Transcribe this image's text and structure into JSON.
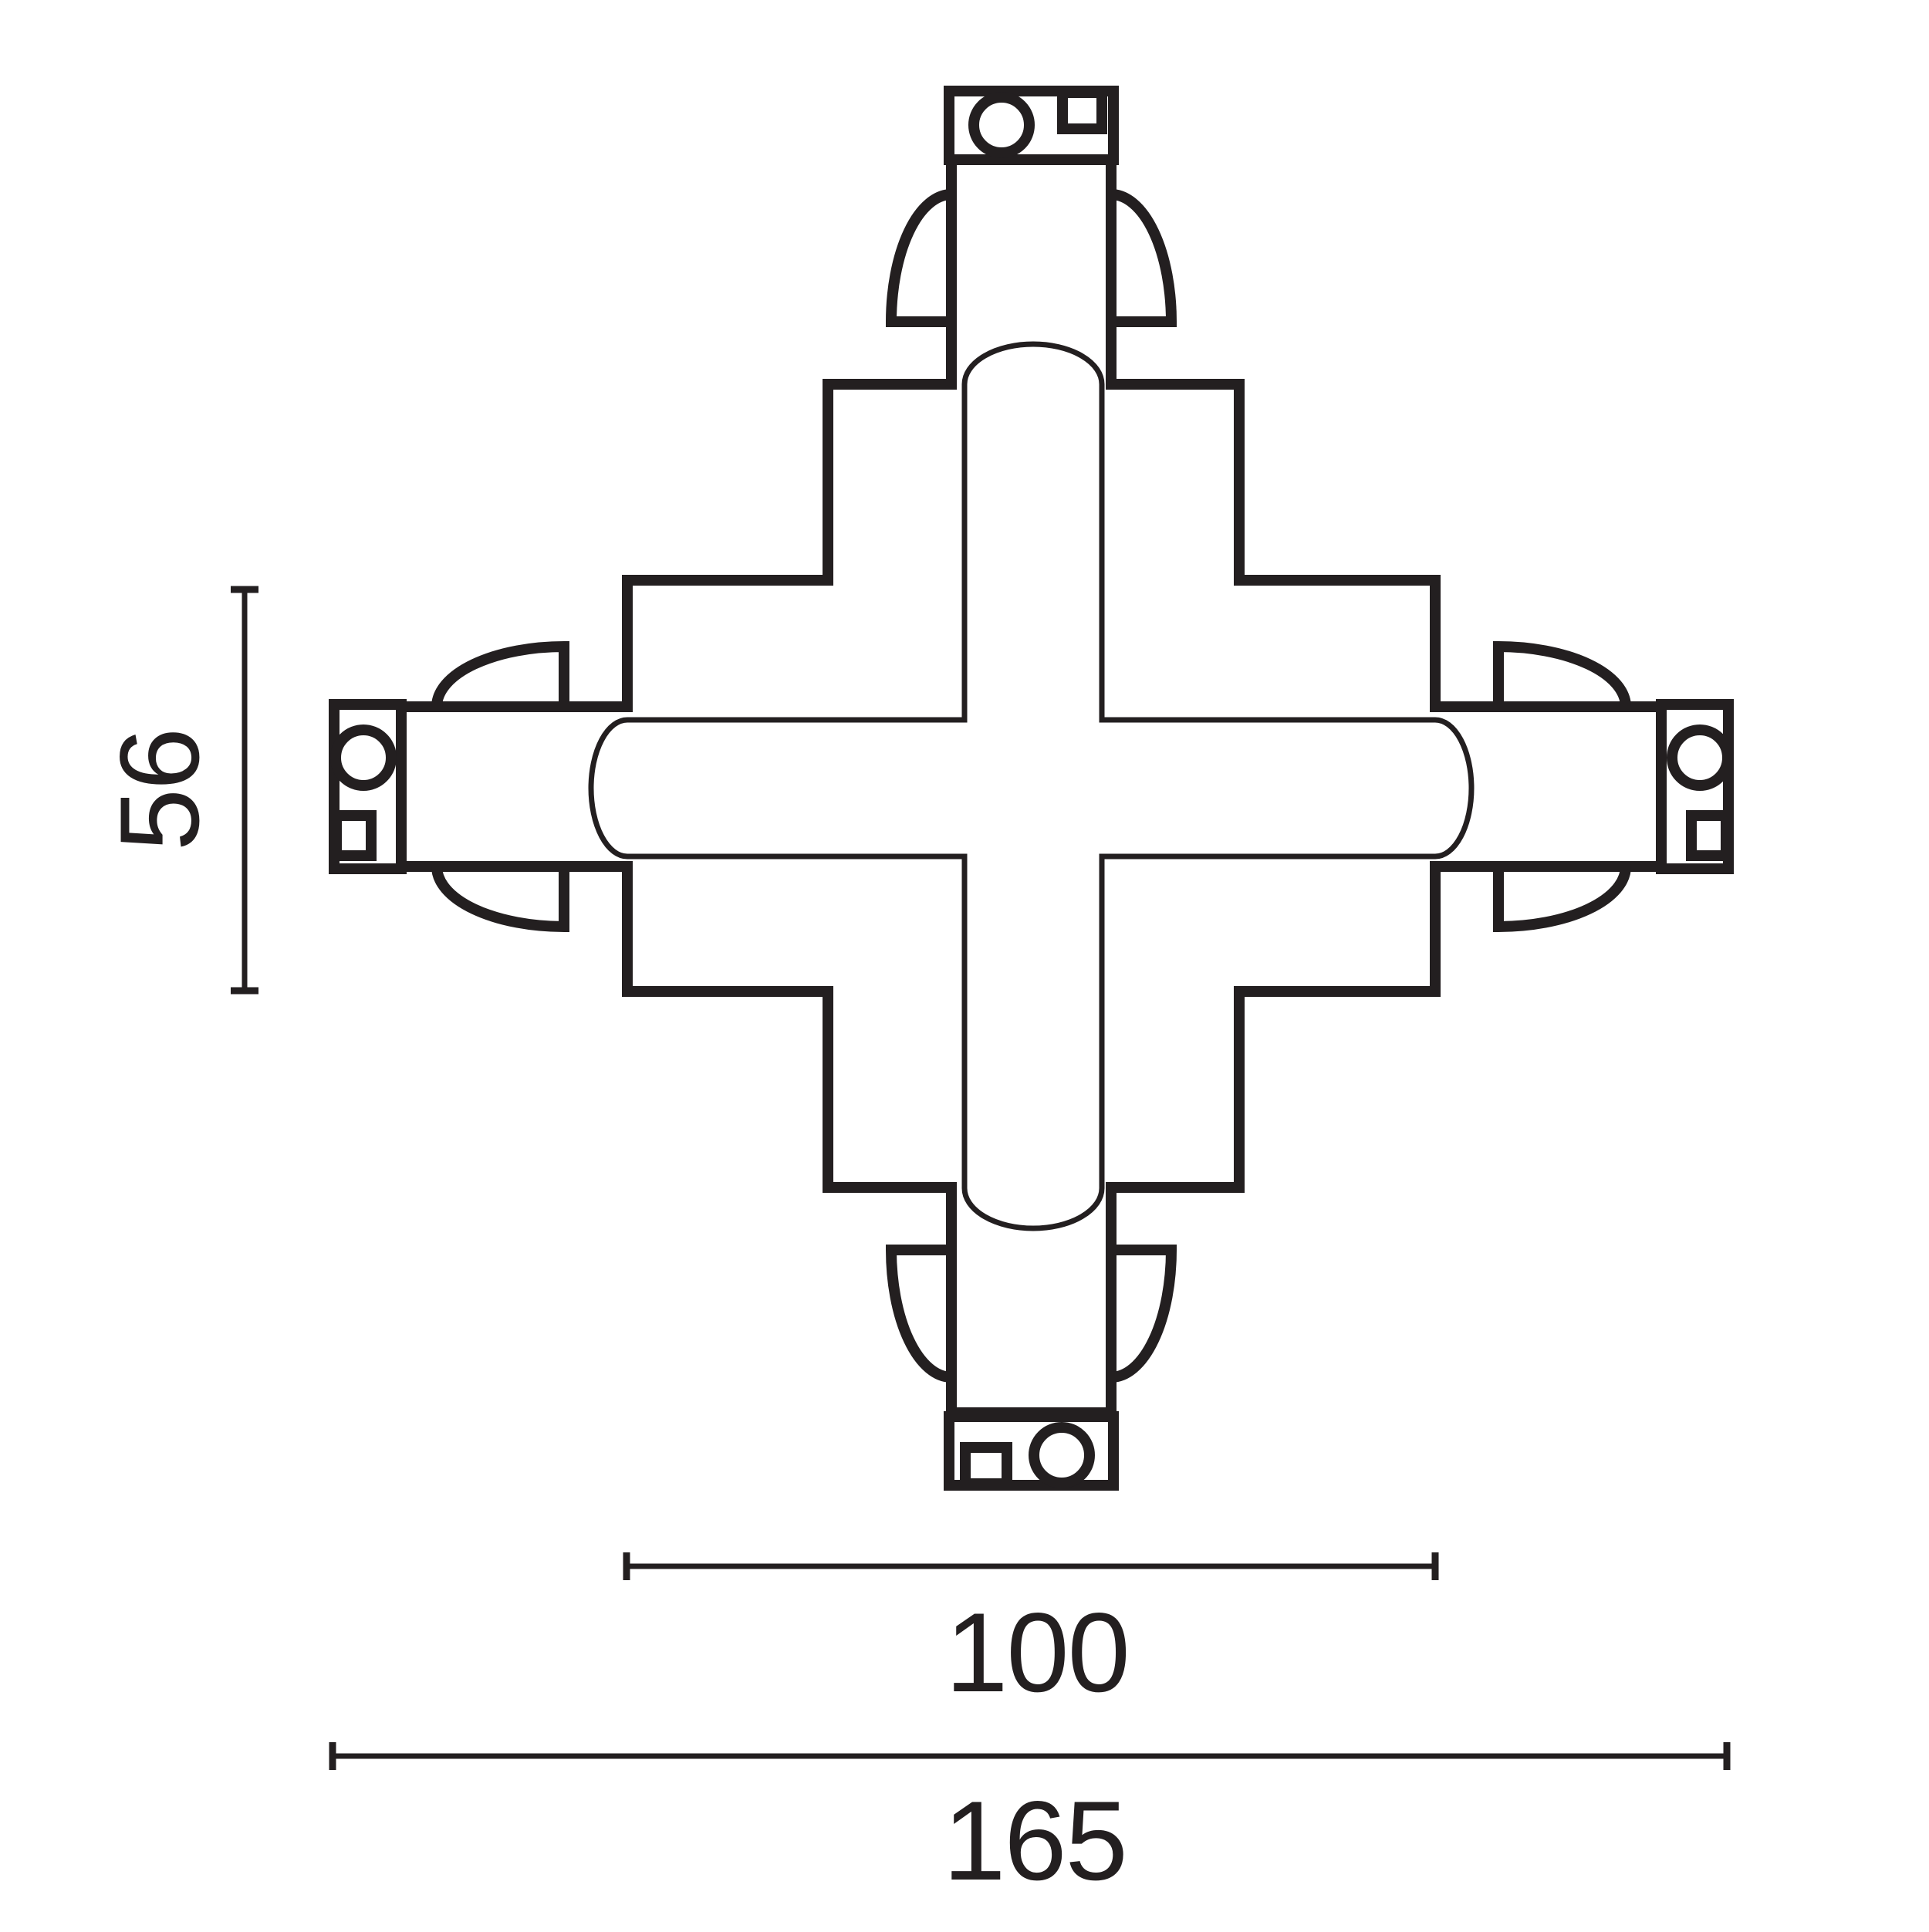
{
  "diagram": {
    "title": "X-shaped track connector - dimensioned technical drawing",
    "view": "plan view line drawing",
    "ink_color": "#231f20",
    "background_color": "#ffffff",
    "dimensions": {
      "vertical_label": "56",
      "inner_horizontal_label": "100",
      "outer_horizontal_label": "165"
    }
  }
}
